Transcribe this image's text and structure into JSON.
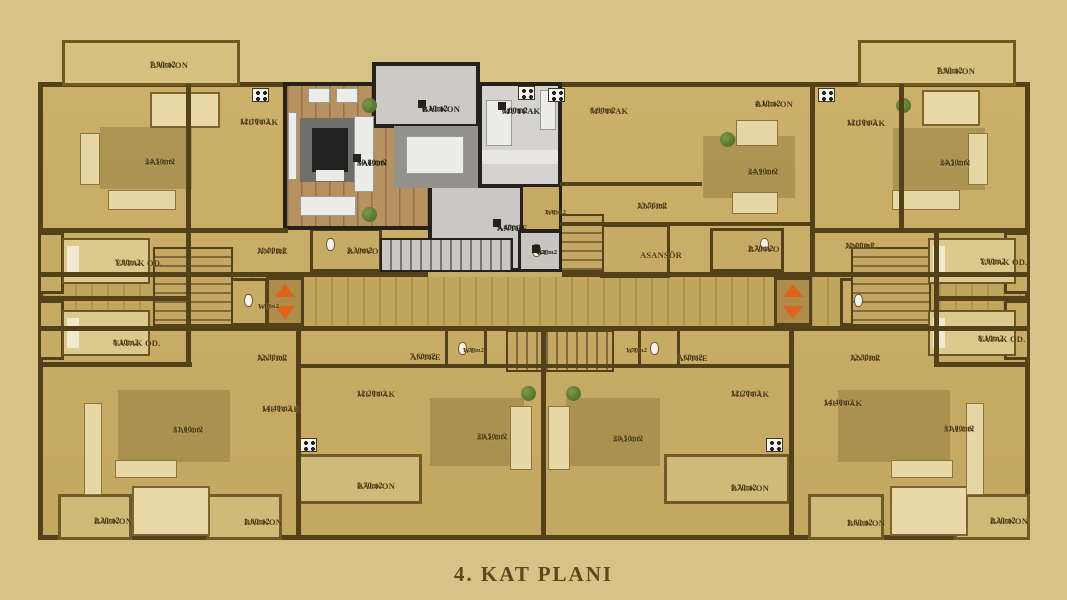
{
  "title": "4. KAT PLANI",
  "colors": {
    "background": "#d9c286",
    "plan_fill": "#c8ac65",
    "walls": "#53411a",
    "highlight_wall": "#262219",
    "highlight_floor": "#c9c8c4",
    "highlight_wood": "#b89160",
    "elevator_arrow": "#dd6418",
    "label_text": "#4a3a14",
    "title_text": "#5e4820"
  },
  "plan": {
    "rooms": [
      {
        "name": "BALKON",
        "area": "7,90m2",
        "x": 150,
        "y": 60,
        "kind": "tan"
      },
      {
        "name": "MUTFAK",
        "area": "12,10m2",
        "x": 240,
        "y": 117,
        "kind": "tan"
      },
      {
        "name": "SALON",
        "area": "24,50m2",
        "x": 145,
        "y": 157,
        "kind": "tan"
      },
      {
        "name": "YATAK OD.",
        "area": "7,90m2",
        "x": 115,
        "y": 258,
        "kind": "tan"
      },
      {
        "name": "ANTRE",
        "area": "11,00m2",
        "x": 257,
        "y": 246,
        "kind": "tan"
      },
      {
        "name": "BANYO",
        "area": "3,30m2",
        "x": 347,
        "y": 246,
        "kind": "tan"
      },
      {
        "name": "W.C",
        "area": "1,40m2",
        "x": 258,
        "y": 303,
        "kind": "tan",
        "small": true
      },
      {
        "name": "YATAK OD.",
        "area": "8,10m2",
        "x": 113,
        "y": 338,
        "kind": "tan"
      },
      {
        "name": "ANTRE",
        "area": "12,30m2",
        "x": 257,
        "y": 353,
        "kind": "tan"
      },
      {
        "name": "MUTFAK",
        "area": "14,40m2",
        "x": 262,
        "y": 404,
        "kind": "tan"
      },
      {
        "name": "SALON",
        "area": "31,00m2",
        "x": 173,
        "y": 425,
        "kind": "tan"
      },
      {
        "name": "BALKON",
        "area": "2,20m2",
        "x": 94,
        "y": 516,
        "kind": "tan"
      },
      {
        "name": "BALKON",
        "area": "1,60m2",
        "x": 244,
        "y": 517,
        "kind": "tan"
      },
      {
        "name": "MUTFAK",
        "area": "12,20m2",
        "x": 357,
        "y": 389,
        "kind": "tan"
      },
      {
        "name": "BALKON",
        "area": "5,70m2",
        "x": 357,
        "y": 481,
        "kind": "tan"
      },
      {
        "name": "ANTRE",
        "area": "7,60m2",
        "x": 410,
        "y": 352,
        "kind": "tan"
      },
      {
        "name": "WC",
        "area": "1,70m2",
        "x": 463,
        "y": 347,
        "kind": "tan",
        "small": true
      },
      {
        "name": "SALON",
        "area": "20,50m2",
        "x": 477,
        "y": 432,
        "kind": "tan"
      },
      {
        "name": "WC",
        "area": "1,70m2",
        "x": 626,
        "y": 347,
        "kind": "tan",
        "small": true
      },
      {
        "name": "ANTRE",
        "area": "7,60m2",
        "x": 677,
        "y": 353,
        "kind": "tan"
      },
      {
        "name": "SALON",
        "area": "20,50m2",
        "x": 613,
        "y": 434,
        "kind": "tan"
      },
      {
        "name": "MUTFAK",
        "area": "8,90m2",
        "x": 590,
        "y": 106,
        "kind": "tan"
      },
      {
        "name": "ANTRE",
        "area": "13,56m2",
        "x": 637,
        "y": 201,
        "kind": "tan"
      },
      {
        "name": "ASANSÖR",
        "area": "",
        "x": 640,
        "y": 250,
        "kind": "tan"
      },
      {
        "name": "BALKON",
        "area": "4,10m2",
        "x": 755,
        "y": 99,
        "kind": "tan"
      },
      {
        "name": "SALON",
        "area": "24,90m2",
        "x": 748,
        "y": 167,
        "kind": "tan"
      },
      {
        "name": "BANYO",
        "area": "2,70m2",
        "x": 748,
        "y": 244,
        "kind": "tan"
      },
      {
        "name": "ANTRE",
        "area": "11,00m2",
        "x": 845,
        "y": 241,
        "kind": "tan"
      },
      {
        "name": "MUTFAK",
        "area": "12,10m2",
        "x": 847,
        "y": 118,
        "kind": "tan"
      },
      {
        "name": "BALKON",
        "area": "7,90m2",
        "x": 937,
        "y": 66,
        "kind": "tan"
      },
      {
        "name": "SALON",
        "area": "24,50m2",
        "x": 940,
        "y": 158,
        "kind": "tan"
      },
      {
        "name": "YATAK OD.",
        "area": "7,90m2",
        "x": 980,
        "y": 257,
        "kind": "tan"
      },
      {
        "name": "YATAK OD.",
        "area": "8,10m2",
        "x": 978,
        "y": 334,
        "kind": "tan"
      },
      {
        "name": "ANTRE",
        "area": "12,30m2",
        "x": 850,
        "y": 353,
        "kind": "tan"
      },
      {
        "name": "MUTFAK",
        "area": "12,20m2",
        "x": 731,
        "y": 389,
        "kind": "tan"
      },
      {
        "name": "MUTFAK",
        "area": "14,40m2",
        "x": 824,
        "y": 398,
        "kind": "tan"
      },
      {
        "name": "SALON",
        "area": "31,00m2",
        "x": 944,
        "y": 424,
        "kind": "tan"
      },
      {
        "name": "BALKON",
        "area": "5,70m2",
        "x": 731,
        "y": 483,
        "kind": "tan"
      },
      {
        "name": "BALKON",
        "area": "1,60m2",
        "x": 847,
        "y": 518,
        "kind": "tan"
      },
      {
        "name": "BALKON",
        "area": "2,20m2",
        "x": 990,
        "y": 516,
        "kind": "tan"
      },
      {
        "name": "BALKON",
        "area": "4,10m2",
        "x": 422,
        "y": 104,
        "kind": "hl"
      },
      {
        "name": "SALON",
        "area": "30,80m2",
        "x": 357,
        "y": 158,
        "kind": "hl"
      },
      {
        "name": "MUTFAK",
        "area": "8,80m2",
        "x": 502,
        "y": 106,
        "kind": "hl"
      },
      {
        "name": "ANTRE",
        "area": "9,40m2",
        "x": 497,
        "y": 223,
        "kind": "hl"
      },
      {
        "name": "WC",
        "area": "2,40m2",
        "x": 545,
        "y": 209,
        "kind": "tan",
        "small": true
      },
      {
        "name": "WC",
        "area": "1,20m2",
        "x": 536,
        "y": 249,
        "kind": "hl",
        "small": true
      }
    ]
  }
}
